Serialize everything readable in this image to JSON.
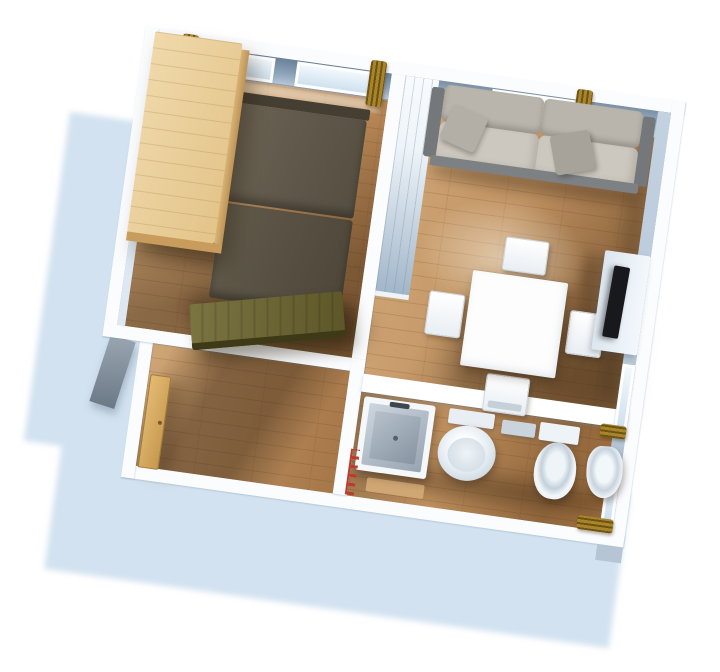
{
  "scene": {
    "type": "3d-floor-plan-render",
    "description": "Isometric 3D rendering of a one-bedroom apartment floor plan viewed from above, on a white background with a soft light-blue cast shadow falling to the lower left. No text labels are visible.",
    "rotation_deg": 8
  },
  "palette": {
    "bg": "#ffffff",
    "cast": "#d2e2f0",
    "wallcap": "#fbfcfe",
    "panel": "#9fb4c8",
    "leftface": "#dde8f2",
    "woodlight": "#d2a878",
    "wooddark": "#ad7c4b",
    "wardrobe": "#f0d9ab",
    "wardrobeside": "#bd9355",
    "bed": "#554e41",
    "beddark": "#4d4639",
    "headboard": "#453e33",
    "bench": "#5d5628",
    "sofa": "#ccc8bf",
    "sofaback": "#b9b5ac",
    "sofadark": "#75787a",
    "tv": "#17191c",
    "curtain": "#a8842a",
    "curtaindark": "#6e5414",
    "tan": "#c6984c",
    "red": "#c0392b",
    "glassa": "#f2f8fd",
    "glassb": "#cfe1ef"
  },
  "rooms": [
    {
      "id": "bedroom",
      "position": "top-left",
      "furniture": [
        "wardrobe",
        "double-bed",
        "storage-bench"
      ],
      "windows": 2,
      "curtains": 2
    },
    {
      "id": "living-room",
      "position": "top-right",
      "furniture": [
        "sofa",
        "throw-pillows",
        "dining-table",
        "four-chairs",
        "tv-cabinet",
        "wall-tv"
      ],
      "windows": 2,
      "curtains": 2
    },
    {
      "id": "hallway",
      "position": "bottom-left",
      "furniture": [
        "entry-door"
      ],
      "windows": 0,
      "curtains": 0
    },
    {
      "id": "bathroom",
      "position": "bottom-right",
      "furniture": [
        "shower-basin",
        "washbasin",
        "toilet",
        "bidet",
        "towel-radiator",
        "bath-mat"
      ],
      "windows": 1,
      "curtains": 1
    }
  ],
  "materials": {
    "floor": "light oak plank flooring",
    "walls": "white wall caps with slate-blue interior faces",
    "curtains": "gold fabric bunches at each window"
  }
}
